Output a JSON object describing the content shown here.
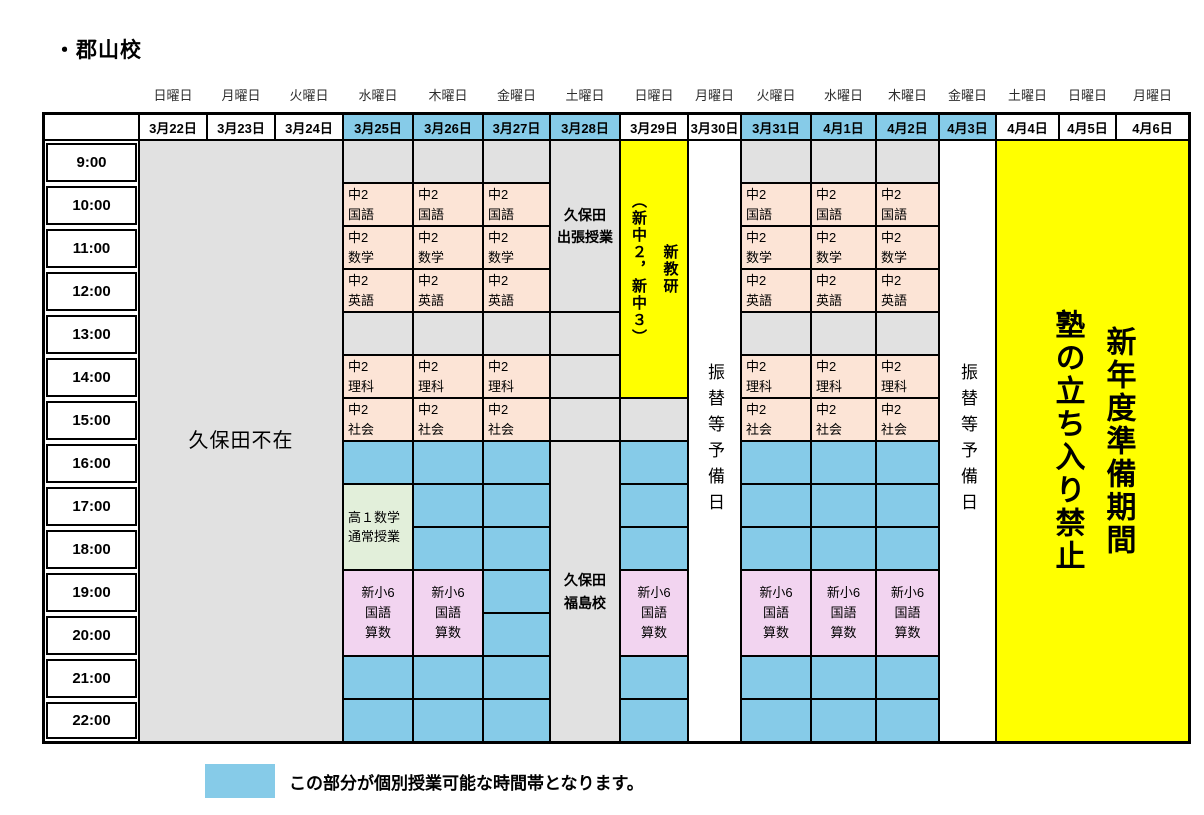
{
  "title": "・郡山校",
  "legend": {
    "text": "この部分が個別授業可能な時間帯となります。"
  },
  "colors": {
    "blue": "#86CBE8",
    "peach": "#FCE4D6",
    "grey": "#E1E1E1",
    "green": "#E2EFDA",
    "violet": "#F2D4F0",
    "yellow": "#FFFF00",
    "white": "#FFFFFF"
  },
  "times": [
    "9:00",
    "10:00",
    "11:00",
    "12:00",
    "13:00",
    "14:00",
    "15:00",
    "16:00",
    "17:00",
    "18:00",
    "19:00",
    "20:00",
    "21:00",
    "22:00"
  ],
  "columns": [
    {
      "day": "日曜日",
      "date": "3月22日",
      "highlight": false
    },
    {
      "day": "月曜日",
      "date": "3月23日",
      "highlight": false
    },
    {
      "day": "火曜日",
      "date": "3月24日",
      "highlight": false
    },
    {
      "day": "水曜日",
      "date": "3月25日",
      "highlight": true
    },
    {
      "day": "木曜日",
      "date": "3月26日",
      "highlight": true
    },
    {
      "day": "金曜日",
      "date": "3月27日",
      "highlight": true
    },
    {
      "day": "土曜日",
      "date": "3月28日",
      "highlight": true
    },
    {
      "day": "日曜日",
      "date": "3月29日",
      "highlight": false
    },
    {
      "day": "月曜日",
      "date": "3月30日",
      "highlight": false
    },
    {
      "day": "火曜日",
      "date": "3月31日",
      "highlight": true
    },
    {
      "day": "水曜日",
      "date": "4月1日",
      "highlight": true
    },
    {
      "day": "木曜日",
      "date": "4月2日",
      "highlight": true
    },
    {
      "day": "金曜日",
      "date": "4月3日",
      "highlight": true
    },
    {
      "day": "土曜日",
      "date": "4月4日",
      "highlight": false
    },
    {
      "day": "日曜日",
      "date": "4月5日",
      "highlight": false
    },
    {
      "day": "月曜日",
      "date": "4月6日",
      "highlight": false
    }
  ],
  "blocks": [
    {
      "c": 0,
      "r": 0,
      "cs": 3,
      "rs": 14,
      "bg": "grey",
      "k": "absent",
      "t": "久保田不在"
    },
    {
      "c": 3,
      "r": 0,
      "bg": "grey",
      "k": "empty"
    },
    {
      "c": 3,
      "r": 1,
      "bg": "peach",
      "k": "class",
      "t": "中2\n国語"
    },
    {
      "c": 3,
      "r": 2,
      "bg": "peach",
      "k": "class",
      "t": "中2\n数学"
    },
    {
      "c": 3,
      "r": 3,
      "bg": "peach",
      "k": "class",
      "t": "中2\n英語"
    },
    {
      "c": 3,
      "r": 4,
      "bg": "grey",
      "k": "empty"
    },
    {
      "c": 3,
      "r": 5,
      "bg": "peach",
      "k": "class",
      "t": "中2\n理科"
    },
    {
      "c": 3,
      "r": 6,
      "bg": "peach",
      "k": "class",
      "t": "中2\n社会"
    },
    {
      "c": 3,
      "r": 7,
      "bg": "blue",
      "k": "avail"
    },
    {
      "c": 3,
      "r": 8,
      "rs": 2,
      "bg": "green",
      "k": "class",
      "t": "高１数学\n通常授業"
    },
    {
      "c": 3,
      "r": 10,
      "rs": 2,
      "bg": "violet",
      "k": "classc",
      "t": "新小6\n国語\n算数"
    },
    {
      "c": 3,
      "r": 12,
      "bg": "blue",
      "k": "avail"
    },
    {
      "c": 3,
      "r": 13,
      "bg": "blue",
      "k": "avail"
    },
    {
      "c": 4,
      "r": 0,
      "bg": "grey",
      "k": "empty"
    },
    {
      "c": 4,
      "r": 1,
      "bg": "peach",
      "k": "class",
      "t": "中2\n国語"
    },
    {
      "c": 4,
      "r": 2,
      "bg": "peach",
      "k": "class",
      "t": "中2\n数学"
    },
    {
      "c": 4,
      "r": 3,
      "bg": "peach",
      "k": "class",
      "t": "中2\n英語"
    },
    {
      "c": 4,
      "r": 4,
      "bg": "grey",
      "k": "empty"
    },
    {
      "c": 4,
      "r": 5,
      "bg": "peach",
      "k": "class",
      "t": "中2\n理科"
    },
    {
      "c": 4,
      "r": 6,
      "bg": "peach",
      "k": "class",
      "t": "中2\n社会"
    },
    {
      "c": 4,
      "r": 7,
      "bg": "blue",
      "k": "avail"
    },
    {
      "c": 4,
      "r": 8,
      "bg": "blue",
      "k": "avail"
    },
    {
      "c": 4,
      "r": 9,
      "bg": "blue",
      "k": "avail"
    },
    {
      "c": 4,
      "r": 10,
      "rs": 2,
      "bg": "violet",
      "k": "classc",
      "t": "新小6\n国語\n算数"
    },
    {
      "c": 4,
      "r": 12,
      "bg": "blue",
      "k": "avail"
    },
    {
      "c": 4,
      "r": 13,
      "bg": "blue",
      "k": "avail"
    },
    {
      "c": 5,
      "r": 0,
      "bg": "grey",
      "k": "empty"
    },
    {
      "c": 5,
      "r": 1,
      "bg": "peach",
      "k": "class",
      "t": "中2\n国語"
    },
    {
      "c": 5,
      "r": 2,
      "bg": "peach",
      "k": "class",
      "t": "中2\n数学"
    },
    {
      "c": 5,
      "r": 3,
      "bg": "peach",
      "k": "class",
      "t": "中2\n英語"
    },
    {
      "c": 5,
      "r": 4,
      "bg": "grey",
      "k": "empty"
    },
    {
      "c": 5,
      "r": 5,
      "bg": "peach",
      "k": "class",
      "t": "中2\n理科"
    },
    {
      "c": 5,
      "r": 6,
      "bg": "peach",
      "k": "class",
      "t": "中2\n社会"
    },
    {
      "c": 5,
      "r": 7,
      "bg": "blue",
      "k": "avail"
    },
    {
      "c": 5,
      "r": 8,
      "bg": "blue",
      "k": "avail"
    },
    {
      "c": 5,
      "r": 9,
      "bg": "blue",
      "k": "avail"
    },
    {
      "c": 5,
      "r": 10,
      "bg": "blue",
      "k": "avail"
    },
    {
      "c": 5,
      "r": 11,
      "bg": "blue",
      "k": "avail"
    },
    {
      "c": 5,
      "r": 12,
      "bg": "blue",
      "k": "avail"
    },
    {
      "c": 5,
      "r": 13,
      "bg": "blue",
      "k": "avail"
    },
    {
      "c": 6,
      "r": 0,
      "rs": 4,
      "bg": "grey",
      "k": "note",
      "t": "久保田\n出張授業"
    },
    {
      "c": 6,
      "r": 4,
      "bg": "grey",
      "k": "empty"
    },
    {
      "c": 6,
      "r": 5,
      "bg": "grey",
      "k": "empty"
    },
    {
      "c": 6,
      "r": 6,
      "bg": "grey",
      "k": "empty"
    },
    {
      "c": 6,
      "r": 7,
      "rs": 7,
      "bg": "grey",
      "k": "note",
      "t": "久保田\n福島校"
    },
    {
      "c": 7,
      "r": 0,
      "rs": 6,
      "bg": "yellow",
      "k": "exam",
      "t": "新教研\n（新中２，新中３）"
    },
    {
      "c": 7,
      "r": 6,
      "bg": "grey",
      "k": "empty"
    },
    {
      "c": 7,
      "r": 7,
      "bg": "blue",
      "k": "avail"
    },
    {
      "c": 7,
      "r": 8,
      "bg": "blue",
      "k": "avail"
    },
    {
      "c": 7,
      "r": 9,
      "bg": "blue",
      "k": "avail"
    },
    {
      "c": 7,
      "r": 10,
      "rs": 2,
      "bg": "violet",
      "k": "classc",
      "t": "新小6\n国語\n算数"
    },
    {
      "c": 7,
      "r": 12,
      "bg": "blue",
      "k": "avail"
    },
    {
      "c": 7,
      "r": 13,
      "bg": "blue",
      "k": "avail"
    },
    {
      "c": 8,
      "r": 0,
      "rs": 14,
      "bg": "white",
      "k": "reserve",
      "t": "振替等予備日"
    },
    {
      "c": 9,
      "r": 0,
      "bg": "grey",
      "k": "empty"
    },
    {
      "c": 9,
      "r": 1,
      "bg": "peach",
      "k": "class",
      "t": "中2\n国語"
    },
    {
      "c": 9,
      "r": 2,
      "bg": "peach",
      "k": "class",
      "t": "中2\n数学"
    },
    {
      "c": 9,
      "r": 3,
      "bg": "peach",
      "k": "class",
      "t": "中2\n英語"
    },
    {
      "c": 9,
      "r": 4,
      "bg": "grey",
      "k": "empty"
    },
    {
      "c": 9,
      "r": 5,
      "bg": "peach",
      "k": "class",
      "t": "中2\n理科"
    },
    {
      "c": 9,
      "r": 6,
      "bg": "peach",
      "k": "class",
      "t": "中2\n社会"
    },
    {
      "c": 9,
      "r": 7,
      "bg": "blue",
      "k": "avail"
    },
    {
      "c": 9,
      "r": 8,
      "bg": "blue",
      "k": "avail"
    },
    {
      "c": 9,
      "r": 9,
      "bg": "blue",
      "k": "avail"
    },
    {
      "c": 9,
      "r": 10,
      "rs": 2,
      "bg": "violet",
      "k": "classc",
      "t": "新小6\n国語\n算数"
    },
    {
      "c": 9,
      "r": 12,
      "bg": "blue",
      "k": "avail"
    },
    {
      "c": 9,
      "r": 13,
      "bg": "blue",
      "k": "avail"
    },
    {
      "c": 10,
      "r": 0,
      "bg": "grey",
      "k": "empty"
    },
    {
      "c": 10,
      "r": 1,
      "bg": "peach",
      "k": "class",
      "t": "中2\n国語"
    },
    {
      "c": 10,
      "r": 2,
      "bg": "peach",
      "k": "class",
      "t": "中2\n数学"
    },
    {
      "c": 10,
      "r": 3,
      "bg": "peach",
      "k": "class",
      "t": "中2\n英語"
    },
    {
      "c": 10,
      "r": 4,
      "bg": "grey",
      "k": "empty"
    },
    {
      "c": 10,
      "r": 5,
      "bg": "peach",
      "k": "class",
      "t": "中2\n理科"
    },
    {
      "c": 10,
      "r": 6,
      "bg": "peach",
      "k": "class",
      "t": "中2\n社会"
    },
    {
      "c": 10,
      "r": 7,
      "bg": "blue",
      "k": "avail"
    },
    {
      "c": 10,
      "r": 8,
      "bg": "blue",
      "k": "avail"
    },
    {
      "c": 10,
      "r": 9,
      "bg": "blue",
      "k": "avail"
    },
    {
      "c": 10,
      "r": 10,
      "rs": 2,
      "bg": "violet",
      "k": "classc",
      "t": "新小6\n国語\n算数"
    },
    {
      "c": 10,
      "r": 12,
      "bg": "blue",
      "k": "avail"
    },
    {
      "c": 10,
      "r": 13,
      "bg": "blue",
      "k": "avail"
    },
    {
      "c": 11,
      "r": 0,
      "bg": "grey",
      "k": "empty"
    },
    {
      "c": 11,
      "r": 1,
      "bg": "peach",
      "k": "class",
      "t": "中2\n国語"
    },
    {
      "c": 11,
      "r": 2,
      "bg": "peach",
      "k": "class",
      "t": "中2\n数学"
    },
    {
      "c": 11,
      "r": 3,
      "bg": "peach",
      "k": "class",
      "t": "中2\n英語"
    },
    {
      "c": 11,
      "r": 4,
      "bg": "grey",
      "k": "empty"
    },
    {
      "c": 11,
      "r": 5,
      "bg": "peach",
      "k": "class",
      "t": "中2\n理科"
    },
    {
      "c": 11,
      "r": 6,
      "bg": "peach",
      "k": "class",
      "t": "中2\n社会"
    },
    {
      "c": 11,
      "r": 7,
      "bg": "blue",
      "k": "avail"
    },
    {
      "c": 11,
      "r": 8,
      "bg": "blue",
      "k": "avail"
    },
    {
      "c": 11,
      "r": 9,
      "bg": "blue",
      "k": "avail"
    },
    {
      "c": 11,
      "r": 10,
      "rs": 2,
      "bg": "violet",
      "k": "classc",
      "t": "新小6\n国語\n算数"
    },
    {
      "c": 11,
      "r": 12,
      "bg": "blue",
      "k": "avail"
    },
    {
      "c": 11,
      "r": 13,
      "bg": "blue",
      "k": "avail"
    },
    {
      "c": 12,
      "r": 0,
      "rs": 14,
      "bg": "white",
      "k": "reserve",
      "t": "振替等予備日"
    },
    {
      "c": 13,
      "r": 0,
      "cs": 3,
      "rs": 14,
      "bg": "yellow",
      "k": "closed",
      "t": "新年度準備期間\n塾の立ち入り禁止"
    }
  ]
}
